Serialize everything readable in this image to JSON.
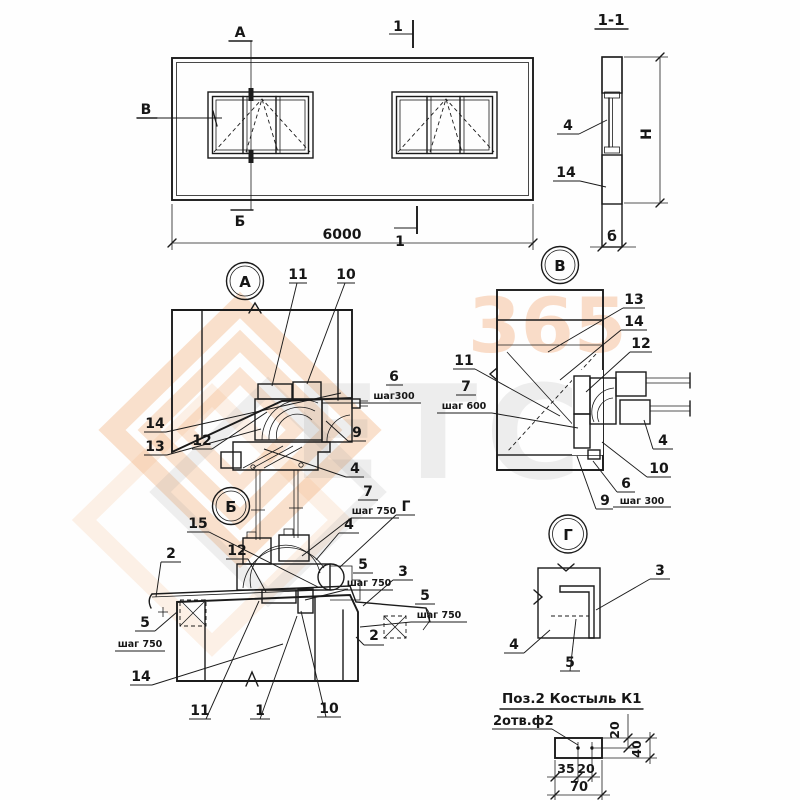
{
  "watermark": {
    "letters": "ЕТС",
    "digits": "365"
  },
  "elevation": {
    "callout_top": "А",
    "callout_bottom": "Б",
    "callout_left": "В",
    "cut_top": "1",
    "cut_bottom": "1",
    "overall_width": "6000"
  },
  "section11": {
    "title": "1-1",
    "height_label": "Н",
    "thickness_label": "б",
    "c4": "4",
    "c14": "14"
  },
  "detailA": {
    "title": "А",
    "c11": "11",
    "c10": "10",
    "c6": "6",
    "c6_step": "шаг300",
    "c9": "9",
    "c4": "4",
    "c14": "14",
    "c13": "13",
    "c12": "12"
  },
  "detailV": {
    "title": "В",
    "c13": "13",
    "c14": "14",
    "c12": "12",
    "c11": "11",
    "c7": "7",
    "c7_step": "шаг 600",
    "c4": "4",
    "c10": "10",
    "c6": "6",
    "c6_step": "шаг 300",
    "c9": "9"
  },
  "detailB": {
    "title": "Б",
    "c15": "15",
    "c2_left": "2",
    "c12": "12",
    "c7": "7",
    "c7_step": "шаг 750",
    "cg": "Г",
    "c4": "4",
    "c5_mid": "5",
    "c5_mid_step": "шаг 750",
    "c3": "3",
    "c5_right": "5",
    "c5_right_step": "шаг 750",
    "c2_right": "2",
    "c5_left": "5",
    "c5_left_step": "шаг 750",
    "c14": "14",
    "c11": "11",
    "c1": "1",
    "c10": "10"
  },
  "detailG": {
    "title": "Г",
    "c3": "3",
    "c4": "4",
    "c5": "5"
  },
  "pos2": {
    "title": "Поз.2  Костыль К1",
    "holes_note": "2отв.ф2",
    "d20_top": "20",
    "d40": "40",
    "d35": "35",
    "d20_bottom": "20",
    "d70": "70"
  }
}
